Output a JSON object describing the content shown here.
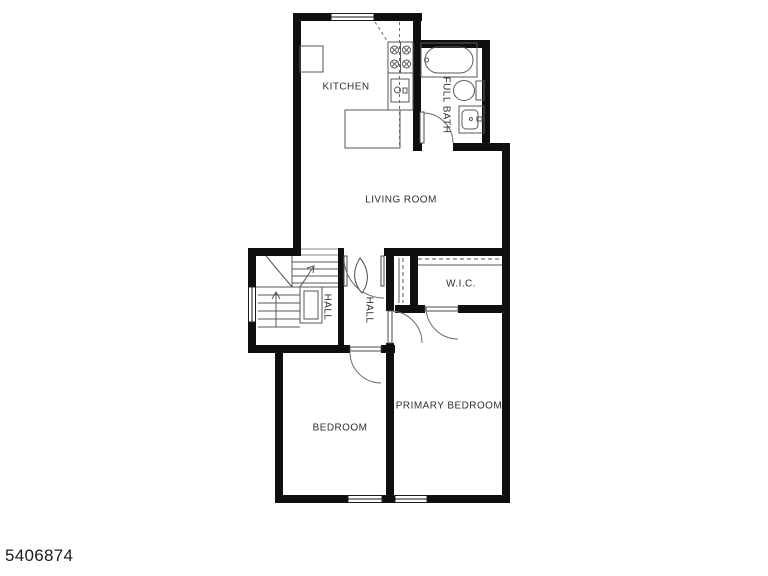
{
  "plan": {
    "title": "apartment-floor-plan",
    "rooms": {
      "kitchen": {
        "label": "KITCHEN"
      },
      "full_bath": {
        "label": "FULL BATH"
      },
      "living_room": {
        "label": "LIVING ROOM"
      },
      "wic": {
        "label": "W.I.C."
      },
      "hall_stairs": {
        "label": "HALL"
      },
      "hall_center": {
        "label": "HALL"
      },
      "bedroom": {
        "label": "BEDROOM"
      },
      "primary_bedroom": {
        "label": "PRIMARY BEDROOM"
      }
    },
    "colors": {
      "wall": "#0f0f0f",
      "fixture_line": "#575757",
      "label_text": "#2f2f2f",
      "background": "#ffffff"
    }
  },
  "footer": {
    "listing_number": "5406874"
  }
}
